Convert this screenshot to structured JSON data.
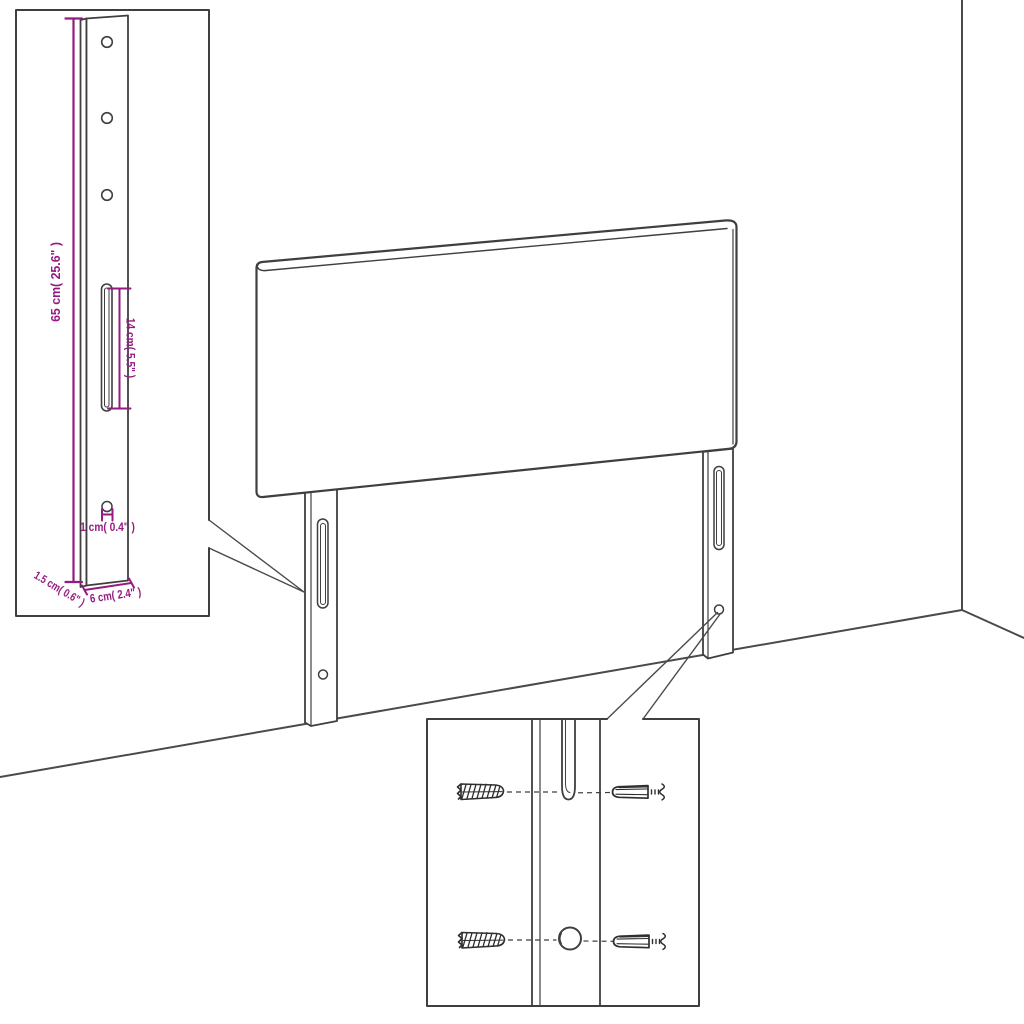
{
  "colors": {
    "background": "#ffffff",
    "line": "#3f3f3f",
    "line_soft": "#4a4a4a",
    "dimension": "#951b81"
  },
  "leg_detail_inset": {
    "dim_height": "65 cm( 25.6\" )",
    "dim_slot": "14 cm( 5.5\" )",
    "dim_hole": "1 cm( 0.4\" )",
    "dim_depth": "1.5 cm( 0.6\" )",
    "dim_width": "6 cm( 2.4\" )"
  }
}
